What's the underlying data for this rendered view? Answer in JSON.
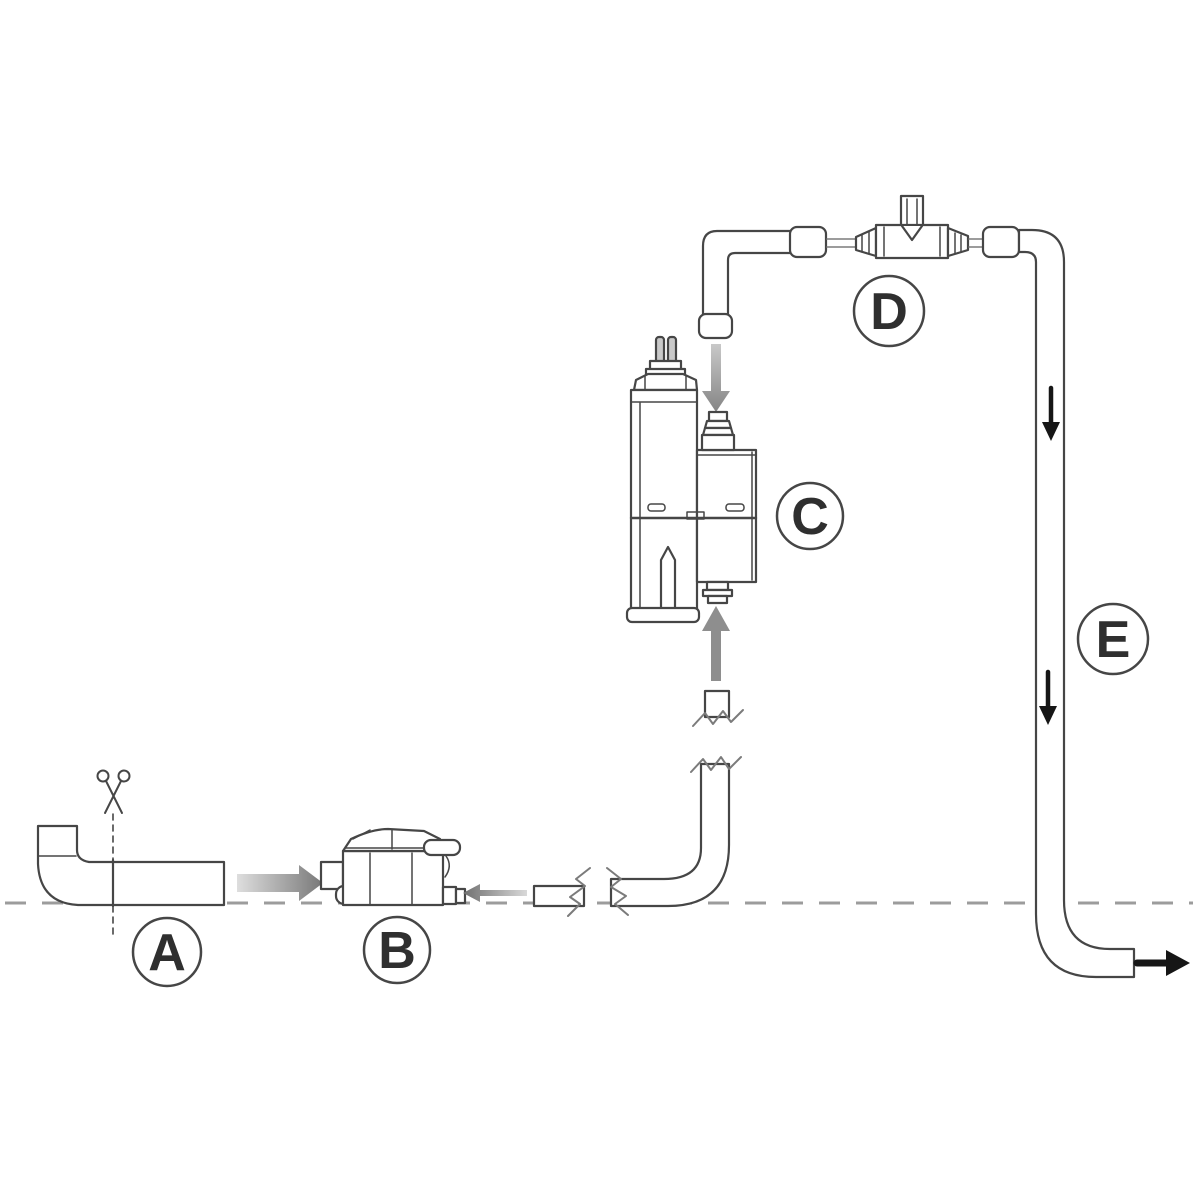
{
  "diagram": {
    "background_color": "#ffffff",
    "line_color": "#464646",
    "soft_line_color": "#7b7b7b",
    "gray_arrow_color": "#8e8e8e",
    "black_arrow_color": "#161616",
    "dash_color": "#9c9c9c",
    "label_text_color": "#2f2f2f",
    "labels": {
      "a": "A",
      "b": "B",
      "c": "C",
      "d": "D",
      "e": "E"
    },
    "icons": {
      "cut_marker": "scissors-icon",
      "flow_markers": [
        "arrow-right-icon",
        "arrow-left-icon",
        "arrow-up-icon",
        "arrow-down-icon"
      ]
    }
  }
}
